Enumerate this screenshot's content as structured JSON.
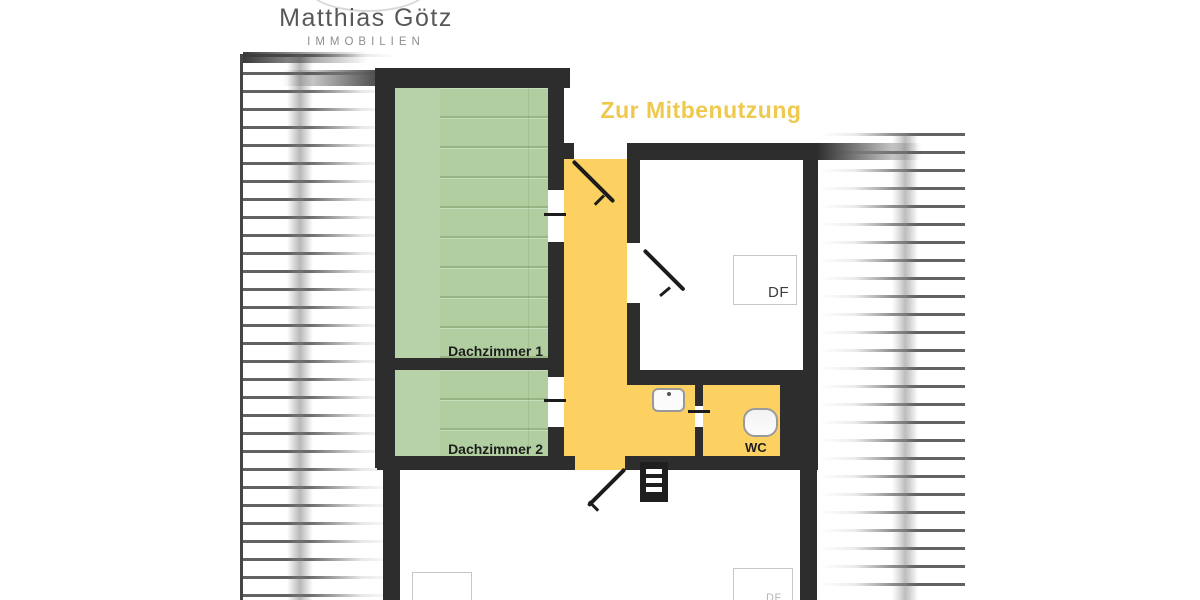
{
  "brand": {
    "name": "Matthias Götz",
    "tagline": "IMMOBILIEN"
  },
  "plan": {
    "title": "Zur Mitbenutzung",
    "room_labels": {
      "dachzimmer1": "Dachzimmer 1",
      "dachzimmer2": "Dachzimmer 2",
      "wc": "WC",
      "roof_window": "DF"
    }
  },
  "colors": {
    "wall": "#2d2d2d",
    "room_green": "#b7d1a8",
    "shared_yellow": "#fcd161",
    "title_gold": "#eec94d",
    "hatch_line": "#474747",
    "fixture_outline": "#999999"
  }
}
